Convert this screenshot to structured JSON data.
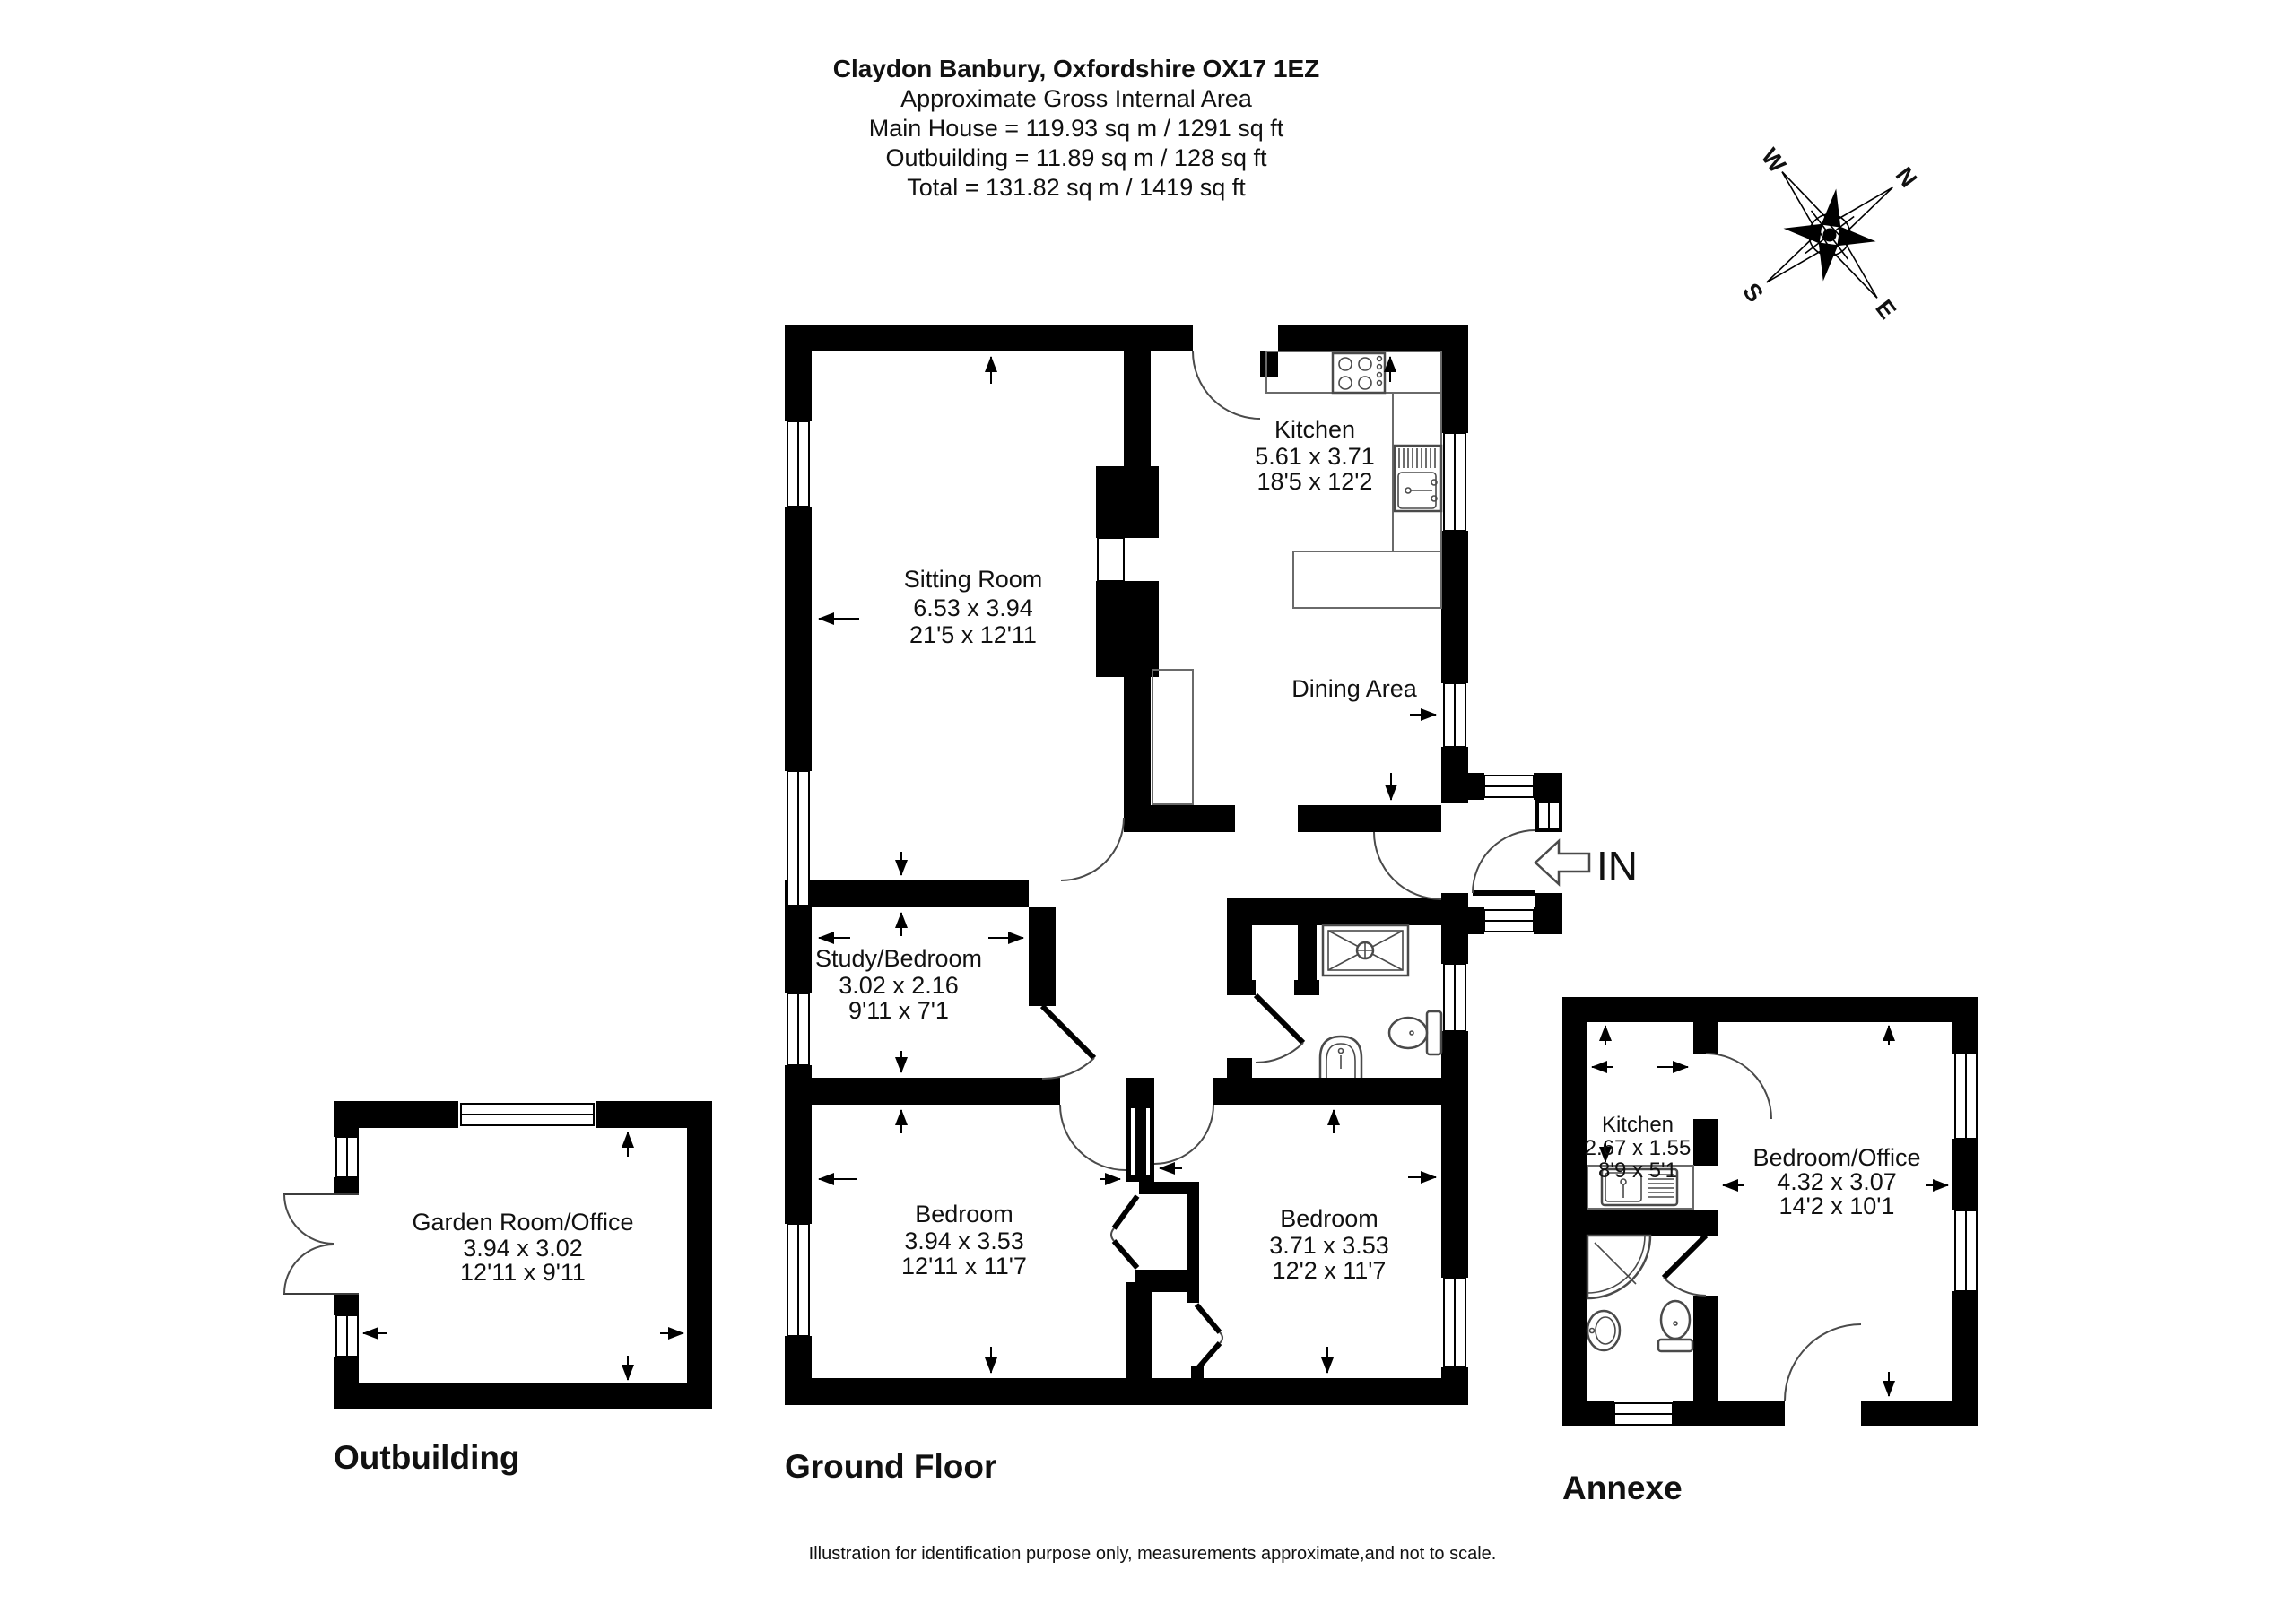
{
  "header": {
    "title": "Claydon Banbury, Oxfordshire OX17 1EZ",
    "lines": [
      "Approximate Gross Internal Area",
      "Main House = 119.93 sq m / 1291 sq ft",
      "Outbuilding = 11.89 sq m / 128 sq ft",
      "Total = 131.82 sq m / 1419 sq ft"
    ]
  },
  "compass": {
    "n": "N",
    "e": "E",
    "s": "S",
    "w": "W"
  },
  "rooms": {
    "sitting_room": {
      "name": "Sitting Room",
      "metric": "6.53 x 3.94",
      "imperial": "21'5 x 12'11"
    },
    "kitchen": {
      "name": "Kitchen",
      "metric": "5.61 x 3.71",
      "imperial": "18'5 x 12'2"
    },
    "dining": {
      "name": "Dining Area"
    },
    "study": {
      "name": "Study/Bedroom",
      "metric": "3.02 x 2.16",
      "imperial": "9'11 x 7'1"
    },
    "bedroom1": {
      "name": "Bedroom",
      "metric": "3.94 x 3.53",
      "imperial": "12'11 x 11'7"
    },
    "bedroom2": {
      "name": "Bedroom",
      "metric": "3.71 x 3.53",
      "imperial": "12'2 x 11'7"
    },
    "garden_room": {
      "name": "Garden Room/Office",
      "metric": "3.94 x 3.02",
      "imperial": "12'11 x 9'11"
    },
    "annexe_kitchen": {
      "name": "Kitchen",
      "metric": "2.67 x 1.55",
      "imperial": "8'9 x 5'1"
    },
    "annexe_bedroom": {
      "name": "Bedroom/Office",
      "metric": "4.32 x 3.07",
      "imperial": "14'2 x 10'1"
    }
  },
  "sections": {
    "ground_floor": "Ground Floor",
    "outbuilding": "Outbuilding",
    "annexe": "Annexe"
  },
  "entrance": {
    "label": "IN"
  },
  "footer": "Illustration for identification purpose only, measurements approximate,and not to scale.",
  "colors": {
    "wall": "#000000",
    "background": "#ffffff",
    "line": "#4a4a4a"
  }
}
